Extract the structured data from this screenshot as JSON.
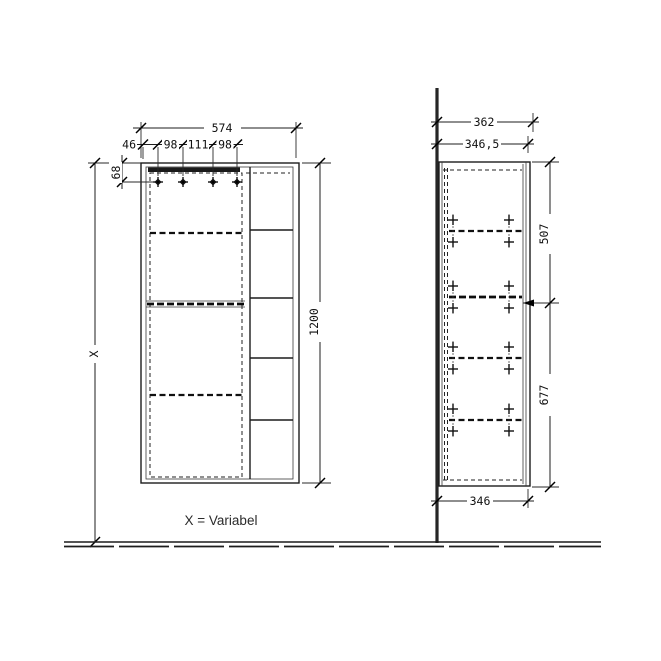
{
  "caption": "X = Variabel",
  "dims": {
    "front": {
      "total_width": "574",
      "hole_offset": "46",
      "hole_gap_a": "98",
      "hole_gap_b": "111",
      "hole_gap_c": "98",
      "top_offset": "68",
      "total_height": "1200",
      "wall_height": "X"
    },
    "side": {
      "total_depth": "362",
      "body_depth": "346,5",
      "upper_height": "507",
      "lower_height": "677",
      "base_depth": "346"
    }
  }
}
